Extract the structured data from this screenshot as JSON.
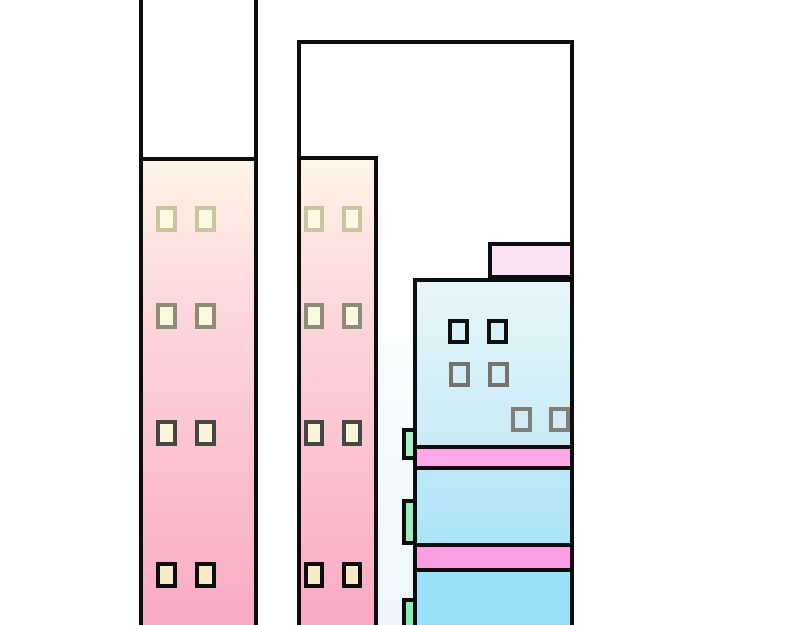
{
  "scene": {
    "description": "cartoon-city-buildings-illustration",
    "canvas": {
      "width": 800,
      "height": 625,
      "background": "#ffffff"
    },
    "outline_color": "#0d0d0d",
    "palette": {
      "pink_facade_top": "#FEF4E7",
      "pink_facade_mid": "#FCD5D9",
      "pink_facade_bottom": "#F9A9C3",
      "white_tower_tint": "#ECF6FA",
      "annex_pink": "#FAE3F4",
      "blue_top": "#E8F6FB",
      "blue_mid": "#BCE8F8",
      "blue_bottom": "#98E2F9",
      "stripe_pink_1": "#FBA9E7",
      "stripe_pink_2": "#F99EE3",
      "balcony_green_1": "#A6F0C5",
      "balcony_green_2": "#99EEBC",
      "balcony_green_3": "#8AEDB4",
      "window_cream": "#FBF9E2",
      "window_tan": "#F7EBC7"
    },
    "elements": [
      {
        "name": "white-tower",
        "x": 297,
        "y": 40,
        "w": 277,
        "h": 593,
        "z": 1,
        "grad": [
          "#FFFFFF 0%",
          "#FBFDFE 50%",
          "#ECF6FA 100%"
        ],
        "borders": {
          "t": 4,
          "l": 4,
          "r": 4
        }
      },
      {
        "name": "white-tower-roof-annex",
        "x": 488,
        "y": 242,
        "w": 86,
        "h": 37,
        "z": 2,
        "fill": "#FAE3F4",
        "borders": {
          "t": 4,
          "l": 4,
          "r": 4,
          "b": 4
        }
      },
      {
        "name": "left-tower-shell",
        "x": 139,
        "y": -8,
        "w": 119,
        "h": 641,
        "z": 3,
        "fill": "#FFFFFF",
        "borders": {
          "l": 4,
          "r": 4
        }
      },
      {
        "name": "left-tower-facade",
        "x": 139,
        "y": 157,
        "w": 119,
        "h": 476,
        "z": 4,
        "grad": [
          "#FEF4E7 0%",
          "#FCD5D9 35%",
          "#F9A9C3 100%"
        ],
        "borders": {
          "t": 4,
          "l": 4,
          "r": 4
        }
      },
      {
        "name": "window",
        "x": 156,
        "y": 206,
        "w": 21,
        "h": 26,
        "z": 5,
        "fill": "#FBF9E2",
        "border_color": "#C8C5A1",
        "borders": {
          "t": 4,
          "l": 4,
          "r": 4,
          "b": 4
        }
      },
      {
        "name": "window",
        "x": 195,
        "y": 206,
        "w": 21,
        "h": 26,
        "z": 5,
        "fill": "#FBF9E2",
        "border_color": "#C8C5A1",
        "borders": {
          "t": 4,
          "l": 4,
          "r": 4,
          "b": 4
        }
      },
      {
        "name": "window",
        "x": 156,
        "y": 303,
        "w": 21,
        "h": 26,
        "z": 5,
        "fill": "#FAF7DF",
        "border_color": "#8D8C7B",
        "borders": {
          "t": 4,
          "l": 4,
          "r": 4,
          "b": 4
        }
      },
      {
        "name": "window",
        "x": 195,
        "y": 303,
        "w": 21,
        "h": 26,
        "z": 5,
        "fill": "#FAF7DF",
        "border_color": "#8D8C7B",
        "borders": {
          "t": 4,
          "l": 4,
          "r": 4,
          "b": 4
        }
      },
      {
        "name": "window",
        "x": 156,
        "y": 420,
        "w": 21,
        "h": 26,
        "z": 5,
        "fill": "#FAF4DA",
        "border_color": "#474741",
        "borders": {
          "t": 4,
          "l": 4,
          "r": 4,
          "b": 4
        }
      },
      {
        "name": "window",
        "x": 195,
        "y": 420,
        "w": 21,
        "h": 26,
        "z": 5,
        "fill": "#FAF4DA",
        "border_color": "#474741",
        "borders": {
          "t": 4,
          "l": 4,
          "r": 4,
          "b": 4
        }
      },
      {
        "name": "window",
        "x": 156,
        "y": 562,
        "w": 21,
        "h": 26,
        "z": 5,
        "fill": "#F7EBC7",
        "border_color": "#0D0D0D",
        "borders": {
          "t": 4,
          "l": 4,
          "r": 4,
          "b": 4
        }
      },
      {
        "name": "window",
        "x": 195,
        "y": 562,
        "w": 21,
        "h": 26,
        "z": 5,
        "fill": "#F7EBC7",
        "border_color": "#0D0D0D",
        "borders": {
          "t": 4,
          "l": 4,
          "r": 4,
          "b": 4
        }
      },
      {
        "name": "middle-tower-facade",
        "x": 297,
        "y": 156,
        "w": 81,
        "h": 477,
        "z": 4,
        "grad": [
          "#FEF4E7 0%",
          "#FCD5D9 35%",
          "#F9A9C3 100%"
        ],
        "borders": {
          "t": 4,
          "l": 4,
          "r": 4
        }
      },
      {
        "name": "window",
        "x": 304,
        "y": 206,
        "w": 20,
        "h": 26,
        "z": 5,
        "fill": "#FBF9E2",
        "border_color": "#C8C5A1",
        "borders": {
          "t": 4,
          "l": 4,
          "r": 4,
          "b": 4
        }
      },
      {
        "name": "window",
        "x": 342,
        "y": 206,
        "w": 20,
        "h": 26,
        "z": 5,
        "fill": "#FBF9E2",
        "border_color": "#C8C5A1",
        "borders": {
          "t": 4,
          "l": 4,
          "r": 4,
          "b": 4
        }
      },
      {
        "name": "window",
        "x": 304,
        "y": 303,
        "w": 20,
        "h": 26,
        "z": 5,
        "fill": "#FAF7DF",
        "border_color": "#8D8C7B",
        "borders": {
          "t": 4,
          "l": 4,
          "r": 4,
          "b": 4
        }
      },
      {
        "name": "window",
        "x": 342,
        "y": 303,
        "w": 20,
        "h": 26,
        "z": 5,
        "fill": "#FAF7DF",
        "border_color": "#8D8C7B",
        "borders": {
          "t": 4,
          "l": 4,
          "r": 4,
          "b": 4
        }
      },
      {
        "name": "window",
        "x": 304,
        "y": 420,
        "w": 20,
        "h": 26,
        "z": 5,
        "fill": "#FAF4DA",
        "border_color": "#474741",
        "borders": {
          "t": 4,
          "l": 4,
          "r": 4,
          "b": 4
        }
      },
      {
        "name": "window",
        "x": 342,
        "y": 420,
        "w": 20,
        "h": 26,
        "z": 5,
        "fill": "#FAF4DA",
        "border_color": "#474741",
        "borders": {
          "t": 4,
          "l": 4,
          "r": 4,
          "b": 4
        }
      },
      {
        "name": "window",
        "x": 304,
        "y": 562,
        "w": 20,
        "h": 26,
        "z": 5,
        "fill": "#F7EBC7",
        "border_color": "#0D0D0D",
        "borders": {
          "t": 4,
          "l": 4,
          "r": 4,
          "b": 4
        }
      },
      {
        "name": "window",
        "x": 342,
        "y": 562,
        "w": 20,
        "h": 26,
        "z": 5,
        "fill": "#F7EBC7",
        "border_color": "#0D0D0D",
        "borders": {
          "t": 4,
          "l": 4,
          "r": 4,
          "b": 4
        }
      },
      {
        "name": "balcony-tab",
        "x": 402,
        "y": 428,
        "w": 17,
        "h": 32,
        "z": 6,
        "fill": "#A6F0C5",
        "borders": {
          "t": 4,
          "l": 4,
          "r": 4,
          "b": 4
        }
      },
      {
        "name": "balcony-tab",
        "x": 402,
        "y": 499,
        "w": 17,
        "h": 46,
        "z": 6,
        "fill": "#99EEBC",
        "borders": {
          "t": 4,
          "l": 4,
          "r": 4,
          "b": 4
        }
      },
      {
        "name": "balcony-tab",
        "x": 402,
        "y": 598,
        "w": 17,
        "h": 36,
        "z": 6,
        "fill": "#8AEDB4",
        "borders": {
          "t": 4,
          "l": 4,
          "r": 4,
          "b": 4
        }
      },
      {
        "name": "blue-tower-top-section",
        "x": 413,
        "y": 278,
        "w": 161,
        "h": 171,
        "z": 7,
        "grad": [
          "#E8F6FB 0%",
          "#C9EBF6 100%"
        ],
        "borders": {
          "t": 4,
          "l": 4,
          "r": 4,
          "b": 4
        }
      },
      {
        "name": "blue-tower-stripe-1",
        "x": 413,
        "y": 449,
        "w": 161,
        "h": 21,
        "z": 7,
        "fill": "#FBA9E7",
        "borders": {
          "l": 4,
          "r": 4,
          "b": 4
        }
      },
      {
        "name": "blue-tower-mid-section",
        "x": 413,
        "y": 470,
        "w": 161,
        "h": 73,
        "z": 7,
        "grad": [
          "#BEE8F7 0%",
          "#ABE4F8 100%"
        ],
        "borders": {
          "l": 4,
          "r": 4
        }
      },
      {
        "name": "blue-tower-stripe-2",
        "x": 413,
        "y": 543,
        "w": 161,
        "h": 29,
        "z": 7,
        "fill": "#F99EE3",
        "borders": {
          "t": 4,
          "l": 4,
          "r": 4,
          "b": 4
        }
      },
      {
        "name": "blue-tower-bottom-section",
        "x": 413,
        "y": 572,
        "w": 161,
        "h": 61,
        "z": 7,
        "fill": "#98E2F9",
        "borders": {
          "l": 4,
          "r": 4
        }
      },
      {
        "name": "window",
        "x": 448,
        "y": 319,
        "w": 21,
        "h": 25,
        "z": 8,
        "fill": "#D8EFF8",
        "border_color": "#0F0F0F",
        "borders": {
          "t": 4,
          "l": 4,
          "r": 4,
          "b": 4
        }
      },
      {
        "name": "window",
        "x": 487,
        "y": 319,
        "w": 21,
        "h": 25,
        "z": 8,
        "fill": "#D8EFF8",
        "border_color": "#0F0F0F",
        "borders": {
          "t": 4,
          "l": 4,
          "r": 4,
          "b": 4
        }
      },
      {
        "name": "window",
        "x": 449,
        "y": 362,
        "w": 21,
        "h": 25,
        "z": 8,
        "fill": "#D5EDF6",
        "border_color": "#74746F",
        "borders": {
          "t": 4,
          "l": 4,
          "r": 4,
          "b": 4
        }
      },
      {
        "name": "window",
        "x": 488,
        "y": 362,
        "w": 21,
        "h": 25,
        "z": 8,
        "fill": "#D5EDF6",
        "border_color": "#74746F",
        "borders": {
          "t": 4,
          "l": 4,
          "r": 4,
          "b": 4
        }
      },
      {
        "name": "window",
        "x": 511,
        "y": 407,
        "w": 21,
        "h": 25,
        "z": 8,
        "fill": "#D2EBF4",
        "border_color": "#80807B",
        "borders": {
          "t": 4,
          "l": 4,
          "r": 4,
          "b": 4
        }
      },
      {
        "name": "window",
        "x": 549,
        "y": 407,
        "w": 21,
        "h": 25,
        "z": 8,
        "fill": "#D2EBF4",
        "border_color": "#80807B",
        "borders": {
          "t": 4,
          "l": 4,
          "r": 4,
          "b": 4
        }
      }
    ]
  }
}
